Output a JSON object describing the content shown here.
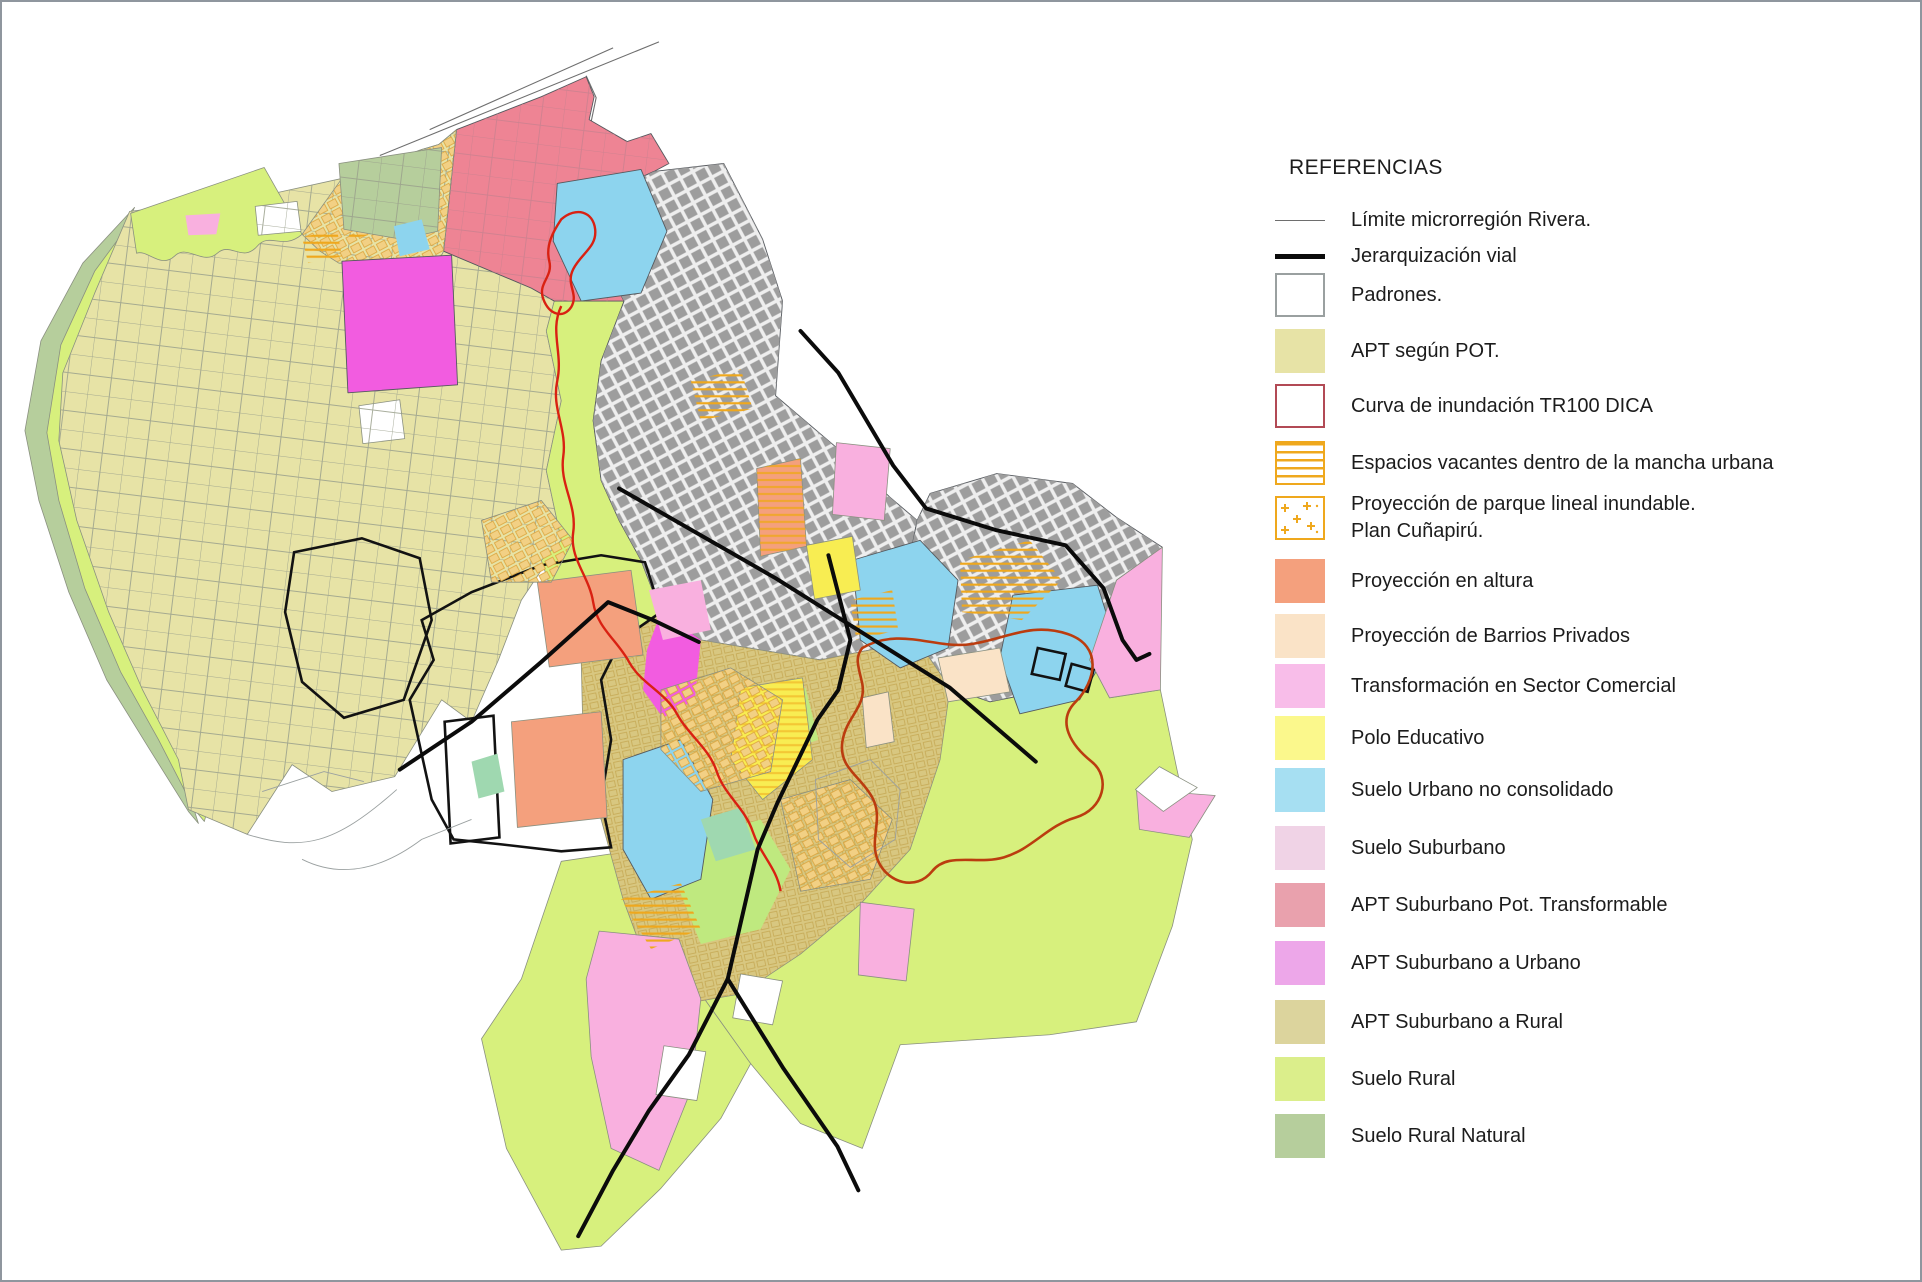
{
  "colors": {
    "frame": "#8f969e",
    "text": "#1c1c1c",
    "white": "#ffffff",
    "khaki": "#e7e3a6",
    "rural": "#dbee8b",
    "rural_map": "#d7f07d",
    "green_band": "#bfe97f",
    "sage": "#b6ce9c",
    "rose": "#e9a1ad",
    "rose_map": "#ee8494",
    "orchid": "#eda7e9",
    "magenta_map": "#f25ce0",
    "tan": "#dcd49d",
    "tan_map": "#d8c780",
    "blue": "#a6dff2",
    "blue_map": "#8dd4ee",
    "seafoam": "#9fd8b0",
    "yellow": "#fbf88c",
    "yellow_map": "#f8ed52",
    "pink": "#f8bde9",
    "pink_map": "#f9b0df",
    "pale_pink": "#f0d3e6",
    "salmon": "#f4a07d",
    "peach": "#fae3c7",
    "orange": "#efa81d",
    "gold": "#dca43c",
    "gold_fill": "#f2d084",
    "urban": "#9d9d9d",
    "urban_bg": "#eeeeee",
    "parcel": "#9aa08c",
    "parcel_rose": "#c9818f",
    "road": "#0b0b0b",
    "red": "#d92112",
    "red_dark": "#bb3c0f",
    "red_border": "#b24a55",
    "thin_line": "#6e6e6e",
    "boundary": "#55595e",
    "swatch_border_gray": "#9aa0a0"
  },
  "legend": {
    "title": "REFERENCIAS",
    "items": [
      {
        "label": "Límite microrregión Rivera.",
        "swatch": "line-thin",
        "color_key": "thin_line"
      },
      {
        "label": "Jerarquización vial",
        "swatch": "line-thick",
        "color_key": "road"
      },
      {
        "label": "Padrones.",
        "swatch": "box",
        "fill_key": "white",
        "border_key": "swatch_border_gray"
      },
      {
        "label": "APT según POT.",
        "swatch": "box",
        "fill_key": "khaki",
        "border_key": "khaki"
      },
      {
        "label": "Curva de inundación TR100 DICA",
        "swatch": "box",
        "fill_key": "white",
        "border_key": "red_border"
      },
      {
        "label": "Espacios vacantes dentro de la mancha urbana",
        "swatch": "hatch",
        "fill_key": "white",
        "border_key": "orange"
      },
      {
        "label": "Proyección de parque lineal inundable.",
        "label2": "Plan Cuñapirú.",
        "swatch": "crosses",
        "fill_key": "white",
        "border_key": "orange"
      },
      {
        "label": "Proyección en altura",
        "swatch": "box",
        "fill_key": "salmon",
        "border_key": "salmon"
      },
      {
        "label": "Proyección de Barrios Privados",
        "swatch": "box",
        "fill_key": "peach",
        "border_key": "peach"
      },
      {
        "label": "Transformación en Sector Comercial",
        "swatch": "box",
        "fill_key": "pink",
        "border_key": "pink"
      },
      {
        "label": "Polo Educativo",
        "swatch": "box",
        "fill_key": "yellow",
        "border_key": "yellow"
      },
      {
        "label": "Suelo Urbano no consolidado",
        "swatch": "box",
        "fill_key": "blue",
        "border_key": "blue"
      },
      {
        "label": "Suelo Suburbano",
        "swatch": "box",
        "fill_key": "pale_pink",
        "border_key": "pale_pink"
      },
      {
        "label": "APT Suburbano Pot. Transformable",
        "swatch": "box",
        "fill_key": "rose",
        "border_key": "rose"
      },
      {
        "label": "APT Suburbano a Urbano",
        "swatch": "box",
        "fill_key": "orchid",
        "border_key": "orchid"
      },
      {
        "label": "APT Suburbano a Rural",
        "swatch": "box",
        "fill_key": "tan",
        "border_key": "tan"
      },
      {
        "label": "Suelo Rural",
        "swatch": "box",
        "fill_key": "rural",
        "border_key": "rural"
      },
      {
        "label": "Suelo Rural Natural",
        "swatch": "box",
        "fill_key": "sage",
        "border_key": "sage"
      }
    ]
  }
}
